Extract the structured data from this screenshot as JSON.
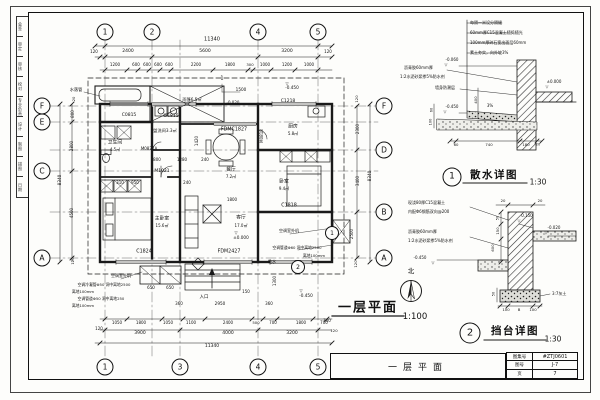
{
  "sheet": {
    "ink": "#1a1a1a",
    "paper": "#fdfdfb"
  },
  "left_strip": {
    "cells": [
      "会签",
      "审定",
      "审核",
      "校对",
      "专业负责",
      "设计",
      "制图",
      "描图",
      "日期"
    ]
  },
  "titlebar": {
    "text": "一层平面"
  },
  "titleblock": {
    "rows": [
      {
        "label": "图集号",
        "value": "#ZTJ0601"
      },
      {
        "label": "图号",
        "value": "J-7"
      },
      {
        "label": "页",
        "value": "7"
      }
    ]
  },
  "plan": {
    "title": "一层平面",
    "scale": "1:100",
    "north_label": "北",
    "grid_bubbles": [
      {
        "n": "1",
        "x": 105,
        "y": 32
      },
      {
        "n": "2",
        "x": 152,
        "y": 32
      },
      {
        "n": "4",
        "x": 258,
        "y": 32
      },
      {
        "n": "5",
        "x": 318,
        "y": 32
      },
      {
        "n": "1",
        "x": 105,
        "y": 367
      },
      {
        "n": "3",
        "x": 180,
        "y": 367
      },
      {
        "n": "4",
        "x": 258,
        "y": 367
      },
      {
        "n": "5",
        "x": 318,
        "y": 367
      },
      {
        "n": "F",
        "x": 42,
        "y": 106
      },
      {
        "n": "E",
        "x": 42,
        "y": 122
      },
      {
        "n": "C",
        "x": 42,
        "y": 171
      },
      {
        "n": "A",
        "x": 42,
        "y": 258
      },
      {
        "n": "F",
        "x": 384,
        "y": 106
      },
      {
        "n": "D",
        "x": 384,
        "y": 150
      },
      {
        "n": "B",
        "x": 384,
        "y": 212
      },
      {
        "n": "A",
        "x": 384,
        "y": 258
      }
    ],
    "detail_refs": [
      {
        "n": "1",
        "x": 332,
        "y": 233
      },
      {
        "n": "2",
        "x": 298,
        "y": 267
      }
    ],
    "labels": {
      "dims": [
        [
          "11340",
          212,
          40,
          5
        ],
        [
          "120",
          94,
          52,
          4
        ],
        [
          "2400",
          128,
          52,
          4.5
        ],
        [
          "5600",
          205,
          52,
          4.5
        ],
        [
          "3200",
          287,
          52,
          4.5
        ],
        [
          "120",
          328,
          52,
          4
        ],
        [
          "1200",
          115,
          65,
          4
        ],
        [
          "600",
          136,
          65,
          4
        ],
        [
          "600",
          147,
          65,
          4
        ],
        [
          "600",
          158,
          65,
          4
        ],
        [
          "600",
          169,
          65,
          4
        ],
        [
          "2200",
          196,
          65,
          4
        ],
        [
          "1800",
          230,
          65,
          4
        ],
        [
          "300",
          250,
          65,
          3.8
        ],
        [
          "1000",
          265,
          65,
          4
        ],
        [
          "1200",
          287,
          65,
          4
        ],
        [
          "1000",
          309,
          65,
          4
        ],
        [
          "1500",
          241,
          90,
          4.2
        ],
        [
          "800",
          157,
          160,
          4
        ],
        [
          "1280",
          182,
          160,
          4
        ],
        [
          "240",
          205,
          160,
          4
        ],
        [
          "1420",
          197,
          141,
          4,
          -90
        ],
        [
          "310",
          120,
          183,
          4
        ],
        [
          "950",
          135,
          183,
          4
        ],
        [
          "240",
          187,
          183,
          4
        ],
        [
          "1800",
          232,
          200,
          4
        ],
        [
          "650",
          151,
          288,
          4
        ],
        [
          "650",
          170,
          288,
          4
        ],
        [
          "360",
          179,
          304,
          4
        ],
        [
          "2950",
          220,
          304,
          4.2
        ],
        [
          "150",
          246,
          292,
          4
        ],
        [
          "360",
          269,
          304,
          4
        ],
        [
          "1300",
          275,
          281,
          4,
          -90
        ],
        [
          "700",
          327,
          321,
          4
        ],
        [
          "120",
          334,
          331,
          3.8
        ],
        [
          "1050",
          117,
          323,
          4
        ],
        [
          "1800",
          141,
          323,
          4
        ],
        [
          "1050",
          168,
          323,
          4
        ],
        [
          "1100",
          191,
          323,
          4
        ],
        [
          "2400",
          228,
          323,
          4
        ],
        [
          "500",
          256,
          323,
          3.8
        ],
        [
          "700",
          273,
          323,
          4
        ],
        [
          "1800",
          301,
          323,
          4
        ],
        [
          "700",
          324,
          323,
          4
        ],
        [
          "3900",
          140,
          334,
          4.5
        ],
        [
          "4000",
          228,
          334,
          4.5
        ],
        [
          "3200",
          292,
          334,
          4.5
        ],
        [
          "11340",
          212,
          347,
          4.5
        ],
        [
          "120",
          99,
          329,
          4
        ],
        [
          "20",
          74,
          99,
          3.8,
          -90
        ],
        [
          "800",
          73,
          114,
          4,
          -90
        ],
        [
          "2800",
          72,
          146,
          4,
          -90
        ],
        [
          "4500",
          72,
          213,
          4,
          -90
        ],
        [
          "120",
          73,
          261,
          3.8,
          -90
        ],
        [
          "8340",
          60,
          180,
          4.2,
          -90
        ],
        [
          "120",
          357,
          99,
          3.8,
          -90
        ],
        [
          "2300",
          358,
          129,
          4,
          -90
        ],
        [
          "3400",
          358,
          181,
          4,
          -90
        ],
        [
          "2500",
          352,
          234,
          4,
          -90
        ],
        [
          "8340",
          370,
          176,
          4.2,
          -90
        ],
        [
          "120",
          356,
          264,
          3.8,
          -90
        ]
      ],
      "codes": [
        [
          "C0815",
          129,
          116,
          4.5
        ],
        [
          "GC815",
          171,
          117,
          4.5
        ],
        [
          "C1218",
          288,
          102,
          4.5
        ],
        [
          "FDMC1827",
          234,
          131,
          4.8
        ],
        [
          "C1824",
          144,
          253,
          4.8
        ],
        [
          "FDM2427",
          229,
          253,
          4.8
        ],
        [
          "C1818",
          289,
          207,
          4.8
        ],
        [
          "M1021",
          162,
          172,
          4.5
        ],
        [
          "M0821A",
          149,
          149,
          4
        ],
        [
          "M0818",
          262,
          136,
          4,
          -90
        ],
        [
          "1",
          222,
          79,
          5
        ]
      ],
      "rooms": [
        [
          "雨篷6.5㎡",
          192,
          100,
          4.2
        ],
        [
          "水落管",
          76,
          90,
          4.2
        ],
        [
          "卫生间",
          115,
          144,
          4.8
        ],
        [
          "4.5㎡",
          115,
          150,
          4
        ],
        [
          "盥洗间3.3㎡",
          165,
          131,
          4.2
        ],
        [
          "餐厅",
          231,
          171,
          4.8
        ],
        [
          "7.2㎡",
          231,
          177,
          4
        ],
        [
          "厨房",
          293,
          128,
          4.8
        ],
        [
          "5.8㎡",
          293,
          134,
          4
        ],
        [
          "主卧室",
          162,
          220,
          4.8
        ],
        [
          "15.6㎡",
          162,
          226,
          4
        ],
        [
          "客厅",
          241,
          219,
          4.8
        ],
        [
          "17.0㎡",
          241,
          226,
          4
        ],
        [
          "卧室",
          284,
          183,
          4.8
        ],
        [
          "9.4㎡",
          284,
          189,
          4
        ],
        [
          "入口",
          204,
          298,
          4.5
        ]
      ],
      "levels": [
        [
          "-0.450",
          292,
          88,
          4.2
        ],
        [
          "▽",
          287,
          84,
          4
        ],
        [
          "-0.020",
          233,
          103,
          4
        ],
        [
          "±0.000",
          241,
          238,
          4.2
        ],
        [
          "▽",
          236,
          233,
          4
        ],
        [
          "-0.450",
          306,
          296,
          4.2
        ],
        [
          "▽",
          301,
          291,
          4
        ]
      ],
      "notes": [
        [
          "空调室外机",
          121,
          276,
          4
        ],
        [
          "空调冷凝管Φ50 洞中离地2500",
          104,
          285,
          3.8
        ],
        [
          "离地100mm",
          83,
          292,
          3.8
        ],
        [
          "空调管道Φ50 洞中离地250",
          101,
          299,
          3.8
        ],
        [
          "离地100mm",
          83,
          306,
          3.8
        ],
        [
          "空调室外机",
          289,
          231,
          4
        ],
        [
          "空调管道Φ60 洞中离地2500",
          297,
          248,
          3.8
        ],
        [
          "离地100mm",
          314,
          256,
          3.8
        ],
        [
          "散水",
          272,
          262,
          4
        ]
      ]
    }
  },
  "details": [
    {
      "num": "1",
      "title": "散水详图",
      "scale": "1:30",
      "labels": {
        "notes": [
          [
            "每隔一米设分隔缝",
            470,
            23,
            4,
            0,
            "l"
          ],
          [
            "60mm厚C15混凝土随捣随光",
            470,
            33,
            4,
            0,
            "l"
          ],
          [
            "100mm厚碎石宽出面层60mm",
            470,
            43,
            4,
            0,
            "l"
          ],
          [
            "素土夯实，向外坡3%",
            470,
            53,
            4,
            0,
            "l"
          ],
          [
            "沥青胶60mm厚",
            404,
            68,
            4,
            0,
            "l"
          ],
          [
            "1:2水泥砂浆掺5%防水剂",
            400,
            77,
            4,
            0,
            "l"
          ],
          [
            "墙身防潮层",
            435,
            88,
            4,
            0,
            "l"
          ],
          [
            "3%",
            490,
            106,
            4
          ]
        ],
        "dims": [
          [
            "400",
            476,
            100,
            3.8,
            -90
          ],
          [
            "60",
            432,
            110,
            3.5,
            -90
          ],
          [
            "100",
            431,
            122,
            3.5,
            -90
          ],
          [
            "60",
            456,
            145,
            3.8
          ],
          [
            "740",
            489,
            145,
            3.8
          ],
          [
            "180",
            526,
            145,
            3.8
          ],
          [
            "20",
            538,
            145,
            3.5
          ]
        ],
        "levels": [
          [
            "-0.060",
            452,
            60,
            4
          ],
          [
            "▽",
            446,
            65,
            3.8
          ],
          [
            "±0.000",
            554,
            82,
            4
          ],
          [
            "▽",
            547,
            87,
            3.8
          ],
          [
            "-0.450",
            452,
            107,
            4
          ],
          [
            "▽",
            445,
            112,
            3.8
          ]
        ]
      }
    },
    {
      "num": "2",
      "title": "挡台详图",
      "scale": "1:30",
      "labels": {
        "notes": [
          [
            "现浇80厚C15混凝土",
            408,
            203,
            4,
            0,
            "l"
          ],
          [
            "内配Φ6钢筋双向@200",
            408,
            212,
            4,
            0,
            "l"
          ],
          [
            "沥青胶60mm厚",
            408,
            232,
            4,
            0,
            "l"
          ],
          [
            "1:2水泥砂浆掺5%防水剂",
            408,
            241,
            4,
            0,
            "l"
          ],
          [
            "3:7灰土",
            552,
            294,
            4,
            0,
            "l"
          ]
        ],
        "dims": [
          [
            "20",
            503,
            201,
            3.8
          ],
          [
            "20",
            540,
            201,
            3.8
          ],
          [
            "50",
            498,
            218,
            3.5,
            -90
          ],
          [
            "150",
            498,
            231,
            3.8,
            -90
          ],
          [
            "600",
            493,
            248,
            3.8,
            -90
          ],
          [
            "50",
            494,
            294,
            3.5,
            -90
          ],
          [
            "100",
            506,
            310,
            3.8
          ],
          [
            "B",
            519,
            310,
            3.8
          ],
          [
            "100",
            533,
            310,
            3.8
          ]
        ],
        "levels": [
          [
            "0.150",
            527,
            216,
            4
          ],
          [
            "▽",
            519,
            221,
            3.8
          ],
          [
            "-0.020",
            554,
            228,
            4
          ],
          [
            "▽",
            546,
            233,
            3.8
          ],
          [
            "-0.450",
            420,
            258,
            4
          ],
          [
            "▽",
            433,
            263,
            3.8
          ]
        ]
      }
    }
  ]
}
